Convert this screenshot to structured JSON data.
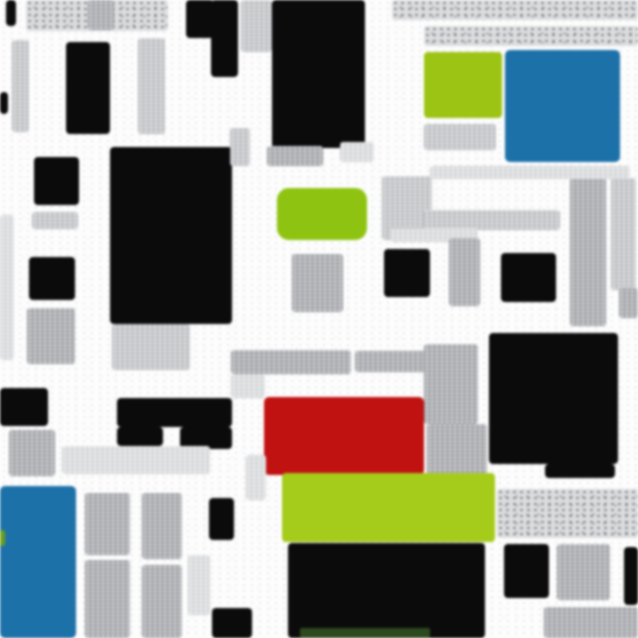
{
  "canvas": {
    "width": 638,
    "height": 638,
    "background": "#fdfdfd"
  },
  "palette": {
    "black": "#0b0b0c",
    "lime_top_right": "#9cc414",
    "lime_center": "#8ec411",
    "lime_band": "#a5cb1b",
    "blue": "#1d71a9",
    "red": "#c11212",
    "dark_green_tinge": "#2d4a1e",
    "gray_texture": "#c6c8cb",
    "background": "#fdfdfd"
  },
  "blocks": [
    {
      "name": "top-left-dark-tick",
      "type": "black",
      "x": 6,
      "y": 0,
      "w": 10,
      "h": 26
    },
    {
      "name": "top-left-texture-band",
      "type": "tex-speckle",
      "x": 26,
      "y": 0,
      "w": 142,
      "h": 31
    },
    {
      "name": "top-left-texture-streak",
      "type": "tex",
      "x": 88,
      "y": 0,
      "w": 26,
      "h": 30
    },
    {
      "name": "top-black-notch",
      "type": "black",
      "x": 186,
      "y": 0,
      "w": 28,
      "h": 38
    },
    {
      "name": "top-black-column",
      "type": "black",
      "x": 211,
      "y": 0,
      "w": 27,
      "h": 77
    },
    {
      "name": "top-texture-column",
      "type": "tex-light",
      "x": 241,
      "y": 0,
      "w": 31,
      "h": 52
    },
    {
      "name": "top-center-black-block",
      "type": "black",
      "x": 272,
      "y": 0,
      "w": 93,
      "h": 148
    },
    {
      "name": "top-right-texture-band-1",
      "type": "tex-speckle",
      "x": 392,
      "y": 0,
      "w": 246,
      "h": 20
    },
    {
      "name": "top-right-texture-band-2",
      "type": "tex-speckle",
      "x": 424,
      "y": 26,
      "w": 214,
      "h": 20
    },
    {
      "name": "lime-block-top-right",
      "type": "lime",
      "x": 424,
      "y": 52,
      "w": 78,
      "h": 66,
      "r": 4,
      "color": "#9cc414"
    },
    {
      "name": "blue-block-top-right",
      "type": "blue",
      "x": 505,
      "y": 50,
      "w": 115,
      "h": 112,
      "r": 5
    },
    {
      "name": "texture-below-lime",
      "type": "tex-light",
      "x": 424,
      "y": 124,
      "w": 72,
      "h": 26
    },
    {
      "name": "left-texture-column-1",
      "type": "tex-light",
      "x": 12,
      "y": 40,
      "w": 17,
      "h": 92
    },
    {
      "name": "left-black-block",
      "type": "black",
      "x": 66,
      "y": 42,
      "w": 44,
      "h": 92
    },
    {
      "name": "left-texture-column-2",
      "type": "tex-light",
      "x": 138,
      "y": 38,
      "w": 27,
      "h": 96
    },
    {
      "name": "left-edge-black-notch",
      "type": "black",
      "x": 0,
      "y": 92,
      "w": 8,
      "h": 22
    },
    {
      "name": "left-black-block-2",
      "type": "black",
      "x": 34,
      "y": 157,
      "w": 45,
      "h": 48
    },
    {
      "name": "center-left-black-mass",
      "type": "black",
      "x": 110,
      "y": 147,
      "w": 122,
      "h": 177
    },
    {
      "name": "texture-below-black-mass",
      "type": "tex-light",
      "x": 112,
      "y": 324,
      "w": 78,
      "h": 46
    },
    {
      "name": "mid-left-texture-band",
      "type": "tex-light",
      "x": 32,
      "y": 212,
      "w": 46,
      "h": 17
    },
    {
      "name": "mid-left-black-square",
      "type": "black",
      "x": 29,
      "y": 257,
      "w": 46,
      "h": 43
    },
    {
      "name": "mid-left-texture-column",
      "type": "tex",
      "x": 27,
      "y": 308,
      "w": 48,
      "h": 56
    },
    {
      "name": "left-edge-texture-strip",
      "type": "tex-faint",
      "x": 0,
      "y": 215,
      "w": 14,
      "h": 145
    },
    {
      "name": "texture-column-230",
      "type": "tex-light",
      "x": 230,
      "y": 128,
      "w": 20,
      "h": 38
    },
    {
      "name": "texture-above-green",
      "type": "tex",
      "x": 267,
      "y": 146,
      "w": 56,
      "h": 20
    },
    {
      "name": "texture-above-green-2",
      "type": "tex-faint",
      "x": 340,
      "y": 142,
      "w": 34,
      "h": 20
    },
    {
      "name": "texture-right-of-green",
      "type": "tex-light",
      "x": 382,
      "y": 176,
      "w": 50,
      "h": 64
    },
    {
      "name": "green-center-block",
      "type": "lime",
      "x": 277,
      "y": 188,
      "w": 90,
      "h": 52,
      "r": 12,
      "color": "#8ec411"
    },
    {
      "name": "center-texture-block",
      "type": "tex",
      "x": 292,
      "y": 254,
      "w": 51,
      "h": 58
    },
    {
      "name": "texture-band-center-top",
      "type": "tex-light",
      "x": 424,
      "y": 210,
      "w": 136,
      "h": 20
    },
    {
      "name": "texture-above-black-square",
      "type": "tex-faint",
      "x": 390,
      "y": 228,
      "w": 88,
      "h": 14
    },
    {
      "name": "center-black-square-1",
      "type": "black",
      "x": 384,
      "y": 249,
      "w": 46,
      "h": 48
    },
    {
      "name": "center-texture-column",
      "type": "tex",
      "x": 449,
      "y": 238,
      "w": 31,
      "h": 68
    },
    {
      "name": "center-black-square-2",
      "type": "black",
      "x": 501,
      "y": 253,
      "w": 55,
      "h": 49
    },
    {
      "name": "right-texture-column-1",
      "type": "tex",
      "x": 570,
      "y": 178,
      "w": 36,
      "h": 148
    },
    {
      "name": "right-texture-column-2",
      "type": "tex-light",
      "x": 611,
      "y": 178,
      "w": 25,
      "h": 112
    },
    {
      "name": "right-edge-gray-block",
      "type": "tex",
      "x": 619,
      "y": 288,
      "w": 19,
      "h": 30
    },
    {
      "name": "right-texture-band",
      "type": "tex-faint",
      "x": 430,
      "y": 166,
      "w": 200,
      "h": 13
    },
    {
      "name": "texture-band-mid-1",
      "type": "tex",
      "x": 231,
      "y": 350,
      "w": 120,
      "h": 24
    },
    {
      "name": "texture-band-mid-2",
      "type": "tex",
      "x": 355,
      "y": 351,
      "w": 73,
      "h": 21
    },
    {
      "name": "texture-block-left-of-big-black",
      "type": "tex",
      "x": 424,
      "y": 344,
      "w": 54,
      "h": 80
    },
    {
      "name": "big-black-square",
      "type": "black",
      "x": 489,
      "y": 333,
      "w": 129,
      "h": 131
    },
    {
      "name": "big-black-extension",
      "type": "black",
      "x": 545,
      "y": 464,
      "w": 70,
      "h": 14
    },
    {
      "name": "texture-small-232",
      "type": "tex-faint",
      "x": 231,
      "y": 374,
      "w": 34,
      "h": 24
    },
    {
      "name": "red-block",
      "type": "red",
      "x": 264,
      "y": 397,
      "w": 160,
      "h": 78,
      "r": 5
    },
    {
      "name": "texture-right-of-red",
      "type": "tex",
      "x": 427,
      "y": 424,
      "w": 60,
      "h": 52
    },
    {
      "name": "green-band",
      "type": "lime",
      "x": 282,
      "y": 473,
      "w": 213,
      "h": 69,
      "r": 4,
      "color": "#a5cb1b"
    },
    {
      "name": "left-black-band",
      "type": "black",
      "x": 0,
      "y": 388,
      "w": 48,
      "h": 38
    },
    {
      "name": "left-texture-block-430",
      "type": "tex",
      "x": 9,
      "y": 430,
      "w": 46,
      "h": 46
    },
    {
      "name": "black-chunk-1",
      "type": "black",
      "x": 117,
      "y": 398,
      "w": 115,
      "h": 29
    },
    {
      "name": "black-chunk-2",
      "type": "black",
      "x": 117,
      "y": 427,
      "w": 46,
      "h": 19
    },
    {
      "name": "black-chunk-3",
      "type": "black",
      "x": 180,
      "y": 427,
      "w": 52,
      "h": 22
    },
    {
      "name": "texture-band-448",
      "type": "tex-faint",
      "x": 62,
      "y": 446,
      "w": 148,
      "h": 28
    },
    {
      "name": "blue-block-bottom-left",
      "type": "blue",
      "x": 0,
      "y": 486,
      "w": 76,
      "h": 152,
      "r": 5
    },
    {
      "name": "green-sliver-left-edge",
      "type": "lime",
      "x": 0,
      "y": 530,
      "w": 5,
      "h": 16,
      "color": "#6aa01a"
    },
    {
      "name": "bottom-left-texture-col-1a",
      "type": "tex",
      "x": 85,
      "y": 493,
      "w": 45,
      "h": 62
    },
    {
      "name": "bottom-left-texture-col-1b",
      "type": "tex",
      "x": 85,
      "y": 560,
      "w": 45,
      "h": 78
    },
    {
      "name": "bottom-left-texture-col-2a",
      "type": "tex",
      "x": 142,
      "y": 493,
      "w": 40,
      "h": 66
    },
    {
      "name": "bottom-left-texture-col-2b",
      "type": "tex",
      "x": 142,
      "y": 565,
      "w": 40,
      "h": 73
    },
    {
      "name": "bottom-left-texture-col-3",
      "type": "tex-faint",
      "x": 188,
      "y": 555,
      "w": 22,
      "h": 60
    },
    {
      "name": "texture-column-248",
      "type": "tex-faint",
      "x": 246,
      "y": 455,
      "w": 20,
      "h": 45
    },
    {
      "name": "bottom-black-small-1",
      "type": "black",
      "x": 209,
      "y": 498,
      "w": 25,
      "h": 42
    },
    {
      "name": "bottom-black-small-2",
      "type": "black",
      "x": 212,
      "y": 608,
      "w": 40,
      "h": 30
    },
    {
      "name": "bottom-center-black-mass",
      "type": "black",
      "x": 288,
      "y": 543,
      "w": 197,
      "h": 95
    },
    {
      "name": "bottom-green-tinge",
      "type": "darkgreen",
      "x": 300,
      "y": 628,
      "w": 130,
      "h": 10
    },
    {
      "name": "bottom-right-texture-band-top",
      "type": "tex-speckle",
      "x": 497,
      "y": 489,
      "w": 141,
      "h": 49
    },
    {
      "name": "bottom-right-black-square",
      "type": "black",
      "x": 504,
      "y": 544,
      "w": 45,
      "h": 54
    },
    {
      "name": "bottom-right-texture-column",
      "type": "tex",
      "x": 557,
      "y": 544,
      "w": 53,
      "h": 56
    },
    {
      "name": "bottom-right-black-edge-strip",
      "type": "black",
      "x": 624,
      "y": 547,
      "w": 14,
      "h": 58
    },
    {
      "name": "bottom-right-texture-band-bottom",
      "type": "tex",
      "x": 544,
      "y": 607,
      "w": 94,
      "h": 31
    }
  ]
}
